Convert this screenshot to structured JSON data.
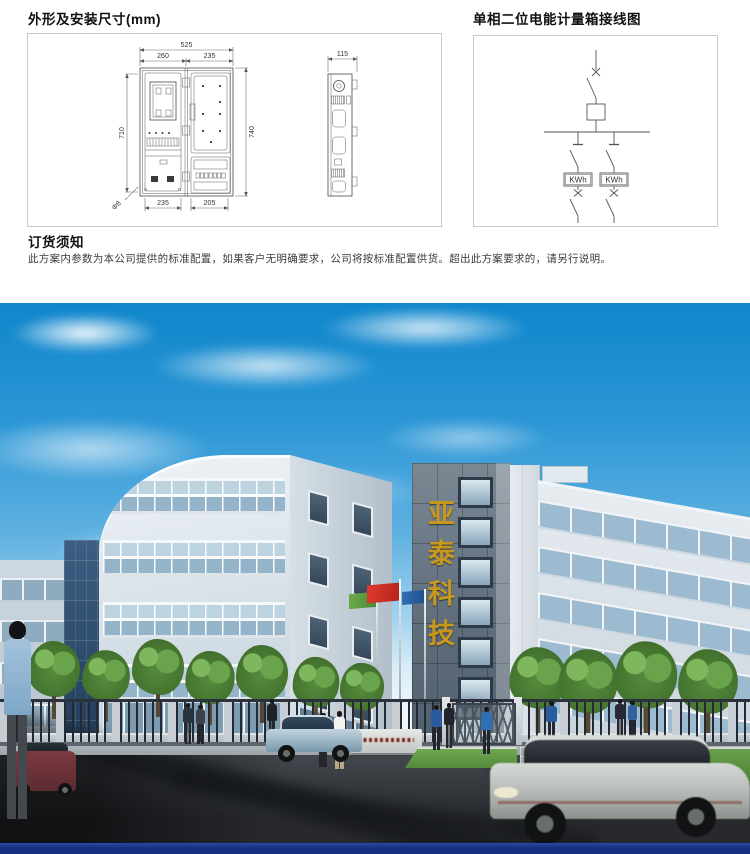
{
  "dimension_panel": {
    "title": "外形及安装尺寸(mm)",
    "front_view": {
      "total_width": "525",
      "left_width": "260",
      "right_width": "235",
      "left_height": "710",
      "right_height": "740",
      "bottom_left_width": "235",
      "bottom_right_width": "205",
      "hole_diameter": "Φ8"
    },
    "side_view": {
      "depth": "115"
    }
  },
  "wiring_panel": {
    "title": "单相二位电能计量箱接线图",
    "meter_label": "KWh"
  },
  "order_notice": {
    "title": "订货须知",
    "body": "此方案内参数为本公司提供的标准配置，如果客户无明确要求，公司将按标准配置供货。超出此方案要求的，请另行说明。"
  },
  "photo": {
    "tower_sign_text": "亚泰科技"
  },
  "colors": {
    "gold": "#c8981e",
    "navy": "#17307f",
    "sky-top": "#0f86cc",
    "flag-red": "#d8342a",
    "flag-green": "#5a9a3e",
    "flag-blue": "#2a63a8",
    "grass": "#568b3d",
    "road": "#2b2e33"
  }
}
